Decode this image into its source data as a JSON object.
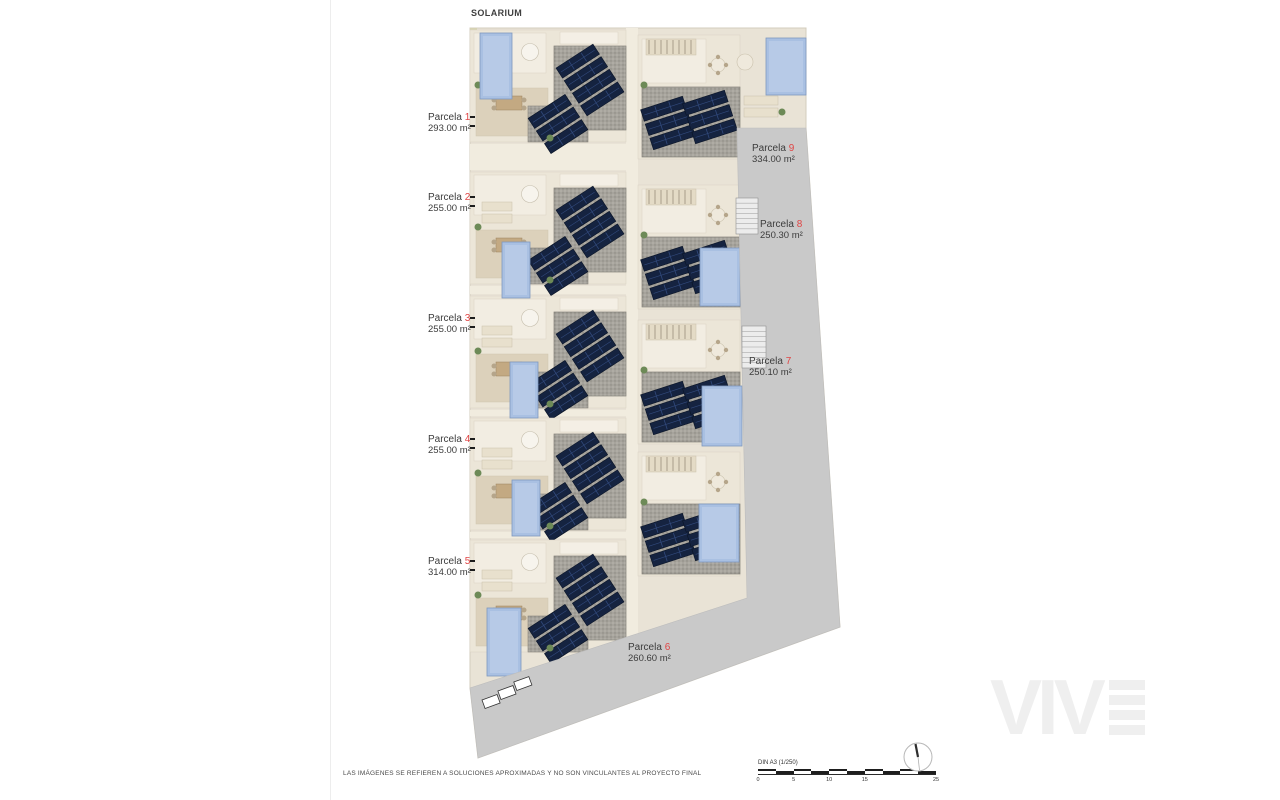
{
  "page": {
    "title": "SOLARIUM",
    "disclaimer": "LAS IMÁGENES SE REFIEREN A SOLUCIONES APROXIMADAS Y NO SON VINCULANTES AL PROYECTO FINAL",
    "watermark": "VIV"
  },
  "parcels": [
    {
      "label": "Parcela",
      "number": "1",
      "area": "293.00 m²"
    },
    {
      "label": "Parcela",
      "number": "2",
      "area": "255.00 m²"
    },
    {
      "label": "Parcela",
      "number": "3",
      "area": "255.00 m²"
    },
    {
      "label": "Parcela",
      "number": "4",
      "area": "255.00 m²"
    },
    {
      "label": "Parcela",
      "number": "5",
      "area": "314.00 m²"
    },
    {
      "label": "Parcela",
      "number": "6",
      "area": "260.60 m²"
    },
    {
      "label": "Parcela",
      "number": "7",
      "area": "250.10 m²"
    },
    {
      "label": "Parcela",
      "number": "8",
      "area": "250.30 m²"
    },
    {
      "label": "Parcela",
      "number": "9",
      "area": "334.00 m²"
    }
  ],
  "scale_bar": {
    "label": "DIN A3 (1/250)",
    "ticks": [
      "0",
      "5",
      "10",
      "15",
      "25"
    ]
  },
  "icons": {
    "north_arrow": "north-arrow"
  },
  "colors": {
    "accent_red": "#e04545",
    "plot_beige": "#e9e3d6",
    "road_gray": "#c9c9c9",
    "pool_blue": "#a9c0e2",
    "solar_navy": "#152340"
  }
}
